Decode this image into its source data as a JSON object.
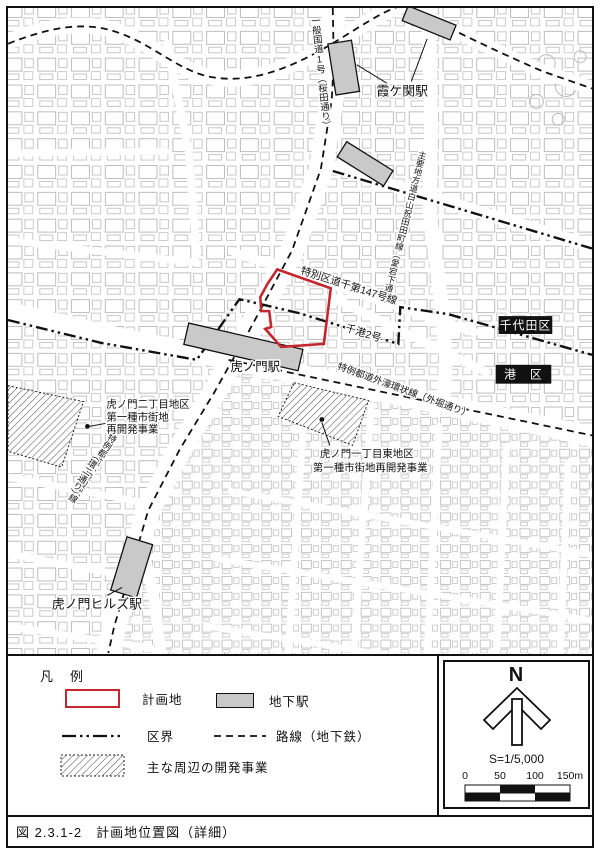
{
  "map": {
    "labels": {
      "route1_vertical": "一般国道1号（桜田通り）",
      "kasumigaseki_station": "霞ケ関駅",
      "hakusan_iwaida_route": "主要地方道白山祝田田町線（愛宕下通り）",
      "ward_road_147": "特別区道千第147号線",
      "senko_2": "千港2号",
      "chiyoda_ward": "千代田区",
      "minato_ward": "港　区",
      "toranomon_station": "虎ノ門駅",
      "sotobori_route": "特例都道外濠環状線（外堀通り）",
      "kanni_route_main": "特例都道外濠環状線",
      "kanni_route_paren": "（環二通り）",
      "toranomon_2chome_line1": "虎ノ門二丁目地区",
      "toranomon_2chome_line2": "第一種市街地",
      "toranomon_2chome_line3": "再開発事業",
      "toranomon_1chome_line1": "虎ノ門一丁目東地区",
      "toranomon_1chome_line2": "第一種市街地再開発事業",
      "toranomon_hills_station": "虎ノ門ヒルズ駅"
    }
  },
  "legend": {
    "title": "凡　例",
    "items": [
      {
        "key": "plan-site",
        "label": "計画地"
      },
      {
        "key": "ward-boundary",
        "label": "区界"
      },
      {
        "key": "development",
        "label": "主な周辺の開発事業"
      },
      {
        "key": "underground-station",
        "label": "地下駅"
      },
      {
        "key": "subway-line",
        "label": "路線（地下鉄）"
      }
    ]
  },
  "compass": {
    "north": "N",
    "scale": "S=1/5,000",
    "ticks": [
      "0",
      "50",
      "100",
      "150m"
    ]
  },
  "caption": "図 2.3.1-2　計画地位置図（詳細）",
  "colors": {
    "plan_site": "#c4272e",
    "station_fill": "#c9c9c9",
    "boundary": "#111111"
  }
}
